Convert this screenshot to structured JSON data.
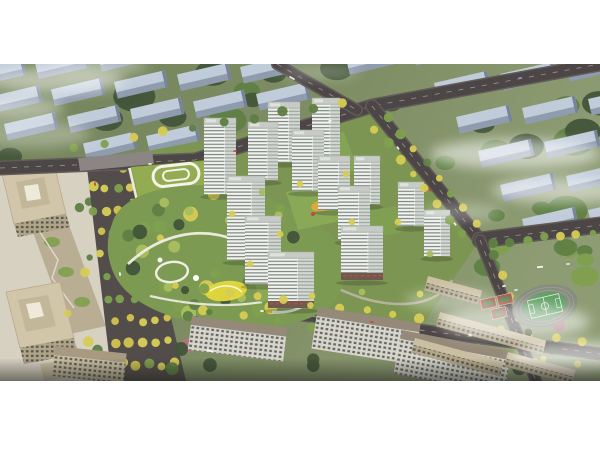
{
  "image": {
    "alt": "Aerial architectural rendering of a residential development: white high-rise apartment towers around landscaped green courtyards, a large central park with winding white paths and a yellow playground, a kindergarten with a green roof, a tree-lined boulevard with yellow trees, beige office towers, a school campus with running track and red courts, rows of city apartment blocks and drifting clouds"
  },
  "palette": {
    "grassL": "#74845a",
    "grassM": "#7e8d64",
    "grassR": "#8e9c74",
    "siteGreen": "#7d9552",
    "treeDark": "#43553a",
    "treeMid": "#5f7f44",
    "treeLight": "#7fa04e",
    "treeLime": "#a9bd5e",
    "treeYellow": "#d5cb55",
    "bgBldTop": "#c1ccda",
    "bgBldFront": "#8f9cae",
    "bgBldEnd": "#76839a",
    "road": "#4c4646",
    "roadEdge": "#625b58",
    "boulevard": "#524d4a",
    "towerFront": "#f3f4f0",
    "towerSide": "#d4d8d3",
    "towerStripe": "#7b847f",
    "towerRoof": "#c7cbc6",
    "retailBase": "#6e5a4e",
    "officeBeige": "#d2c6aa",
    "officeInner": "#c3b79a",
    "officeShadow": "#b0a489",
    "plaza": "#d7d1c2",
    "podium": "#b9ae93",
    "schoolRoof": "#93ab51",
    "schoolWall": "#ece9df",
    "schoolYard": "#9db464",
    "parkBase": "#7d9a52",
    "pathWhite": "#efeee4",
    "playYellow": "#e4d83c",
    "playOrange": "#dca83e",
    "pool": "#7ab8c8",
    "pitch": "#62a067",
    "trackRing": "#878d7f",
    "courtRed": "#ac5a4b",
    "courtGreen": "#5e8a57",
    "slabFacade": "#d7d5cc",
    "slabRoof": "#958a7a",
    "campusBeige": "#cbbfa3",
    "parking": "#8b8683",
    "cloud": "#ffffff",
    "carRed": "#c9463a",
    "carWhite": "#f6f6f3",
    "pink": "#b27283"
  }
}
